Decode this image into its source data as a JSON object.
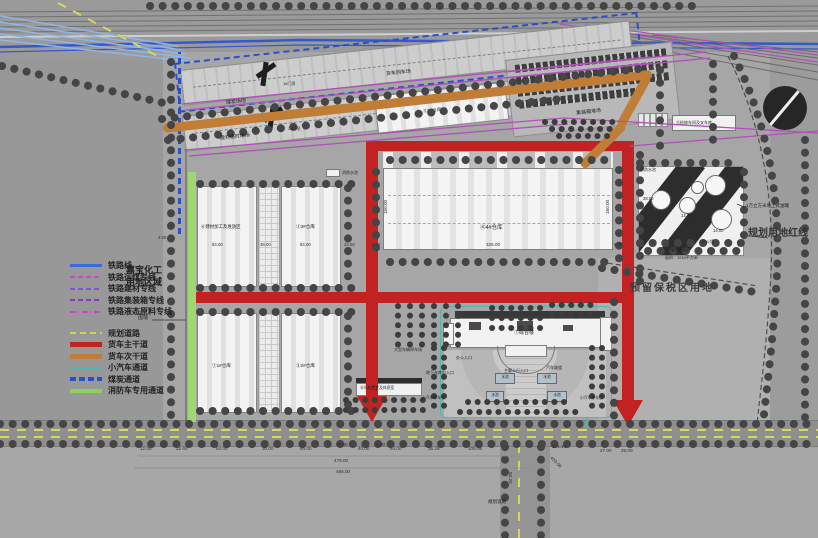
{
  "colors": {
    "truck_main_red": "#c32222",
    "truck_secondary_orange": "#bf7d36",
    "car_lane_teal": "#56b4ac",
    "fire_lane_green": "#8ed05e",
    "railway_blue": "#3a6bd8",
    "coal_channel_blue": "#2b4fc6",
    "rail_spur_purple": "#b050b8",
    "planned_road_yellow": "#d4d44a"
  },
  "legend": {
    "rail_items": [
      {
        "label": "铁路线"
      },
      {
        "label": "铁路运煤专线"
      },
      {
        "label": "铁路建材专线"
      },
      {
        "label": "铁路集装箱专线"
      },
      {
        "label": "铁路液态原料专线"
      }
    ],
    "road_items": [
      {
        "label": "规划道路"
      },
      {
        "label": "货车主干道"
      },
      {
        "label": "货车次干道"
      },
      {
        "label": "小汽车通道"
      },
      {
        "label": "煤炭通道"
      },
      {
        "label": "消防车专用通道"
      }
    ]
  },
  "labels": {
    "jiabao_line1": "嘉宝化工",
    "jiabao_line2": "用地区域",
    "fence": "围墙",
    "coal_yard": "煤炭场地",
    "material_yard": "建材临时堆场",
    "truck_return": "货车回车场",
    "container_yard": "集装箱堆场",
    "crane1": "1#门吊",
    "crane2": "2#门吊",
    "warehouse5": "⑤5#仓库",
    "warehouse4": "④4#仓库",
    "warehouse3": "③3#仓库",
    "warehouse1": "①1#仓库",
    "warehouse2": "②2#仓库",
    "material_area": "⑥建材加工及堆放区",
    "workshop": "⑪检修车间及叉车库",
    "tank_note": "1万立方米地上式油罐",
    "fire_pool_left": "消防水池",
    "fire_pool_right": "消防水池",
    "firewall": "防火墙",
    "green_belt": "绿化隔离区",
    "green_belt_area": "面积：1210平方米",
    "bonded_area": "预留保税区用地",
    "red_line": "规划用地红线",
    "complex": "⑦综合楼",
    "office_entry": "办公入口",
    "ped_entry": "主要人行入口",
    "car_ramp": "汽车坡道",
    "garage_entry": "地下车库出入口",
    "pool": "水池",
    "parking_small": "小汽车停车位",
    "parking_large": "大型车辆停车场",
    "driver_rest": "⑧司机食堂及休息室",
    "road_label": "规划道路"
  },
  "dims": {
    "chain": [
      "12.00",
      "22.60",
      "84.00",
      "30.00",
      "84.00",
      "15.00",
      "40.00",
      "1.00",
      "54.00",
      "36.26",
      "109.06"
    ],
    "total1": "478.00",
    "total2": "488.00",
    "right1": "101.18",
    "right2": "27.00",
    "right3": "25.00",
    "diag": "420.06",
    "wh_left": "84.00",
    "wh_mid": "38.00",
    "wh_right": "84.00",
    "wh_edge": "22.50",
    "wh4_side": "150.00",
    "wh4_len": "325.00",
    "wh4_margin": "6.00",
    "wh5_len": "180.00",
    "tank_w": "28.00",
    "tank_d": "14.00",
    "road_w": "50.20",
    "left_gap": "4.00"
  }
}
